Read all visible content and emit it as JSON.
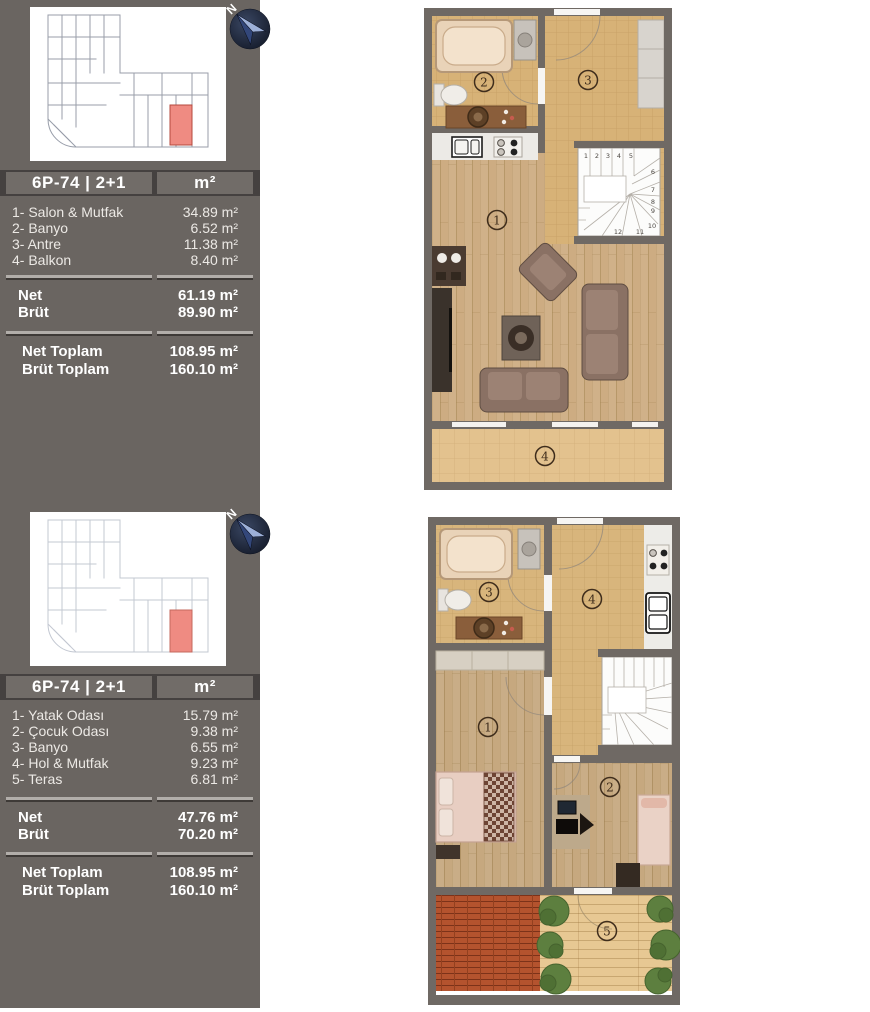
{
  "panels": [
    {
      "unit": "6P-74 | 2+1",
      "area_unit": "m²",
      "rooms": [
        {
          "label": "1- Salon & Mutfak",
          "value": "34.89 m²"
        },
        {
          "label": "2- Banyo",
          "value": "6.52 m²"
        },
        {
          "label": "3- Antre",
          "value": "11.38 m²"
        },
        {
          "label": "4- Balkon",
          "value": "8.40 m²"
        }
      ],
      "net": {
        "label": "Net",
        "value": "61.19 m²"
      },
      "brut": {
        "label": "Brüt",
        "value": "89.90 m²"
      },
      "net_total": {
        "label": "Net Toplam",
        "value": "108.95 m²"
      },
      "brut_total": {
        "label": "Brüt Toplam",
        "value": "160.10 m²"
      }
    },
    {
      "unit": "6P-74 | 2+1",
      "area_unit": "m²",
      "rooms": [
        {
          "label": "1- Yatak Odası",
          "value": "15.79 m²"
        },
        {
          "label": "2- Çocuk Odası",
          "value": "9.38 m²"
        },
        {
          "label": "3- Banyo",
          "value": "6.55 m²"
        },
        {
          "label": "4- Hol & Mutfak",
          "value": "9.23 m²"
        },
        {
          "label": "5- Teras",
          "value": "6.81 m²"
        }
      ],
      "net": {
        "label": "Net",
        "value": "47.76 m²"
      },
      "brut": {
        "label": "Brüt",
        "value": "70.20 m²"
      },
      "net_total": {
        "label": "Net Toplam",
        "value": "108.95 m²"
      },
      "brut_total": {
        "label": "Brüt Toplam",
        "value": "160.10 m²"
      }
    }
  ],
  "compass": {
    "label": "N"
  },
  "floorplans": [
    {
      "numbers": {
        "living": "1",
        "bath": "2",
        "antre": "3",
        "balcony": "4"
      },
      "stair_numbers": [
        "1",
        "2",
        "3",
        "4",
        "5",
        "6",
        "7",
        "8",
        "9",
        "10",
        "11",
        "12"
      ]
    },
    {
      "numbers": {
        "bedroom": "1",
        "kids": "2",
        "bath": "3",
        "hall": "4",
        "terrace": "5"
      }
    }
  ],
  "colors": {
    "sidebar_bg": "#6a6561",
    "band_bg": "#454140",
    "cell_bg": "#716c68",
    "separator_light": "#b2aeaa",
    "separator_dark": "#3e3a37",
    "wall": "#6f6964",
    "tile": "#d7b277",
    "wood": "#cdac82",
    "balcony_tile": "#e3c28e",
    "terrace_roof": "#b4532e",
    "deck": "#e7c893",
    "bush_green": "#5d7f3f",
    "highlight_unit": "#ef8b82",
    "compass_blue": "#9db0d8"
  }
}
